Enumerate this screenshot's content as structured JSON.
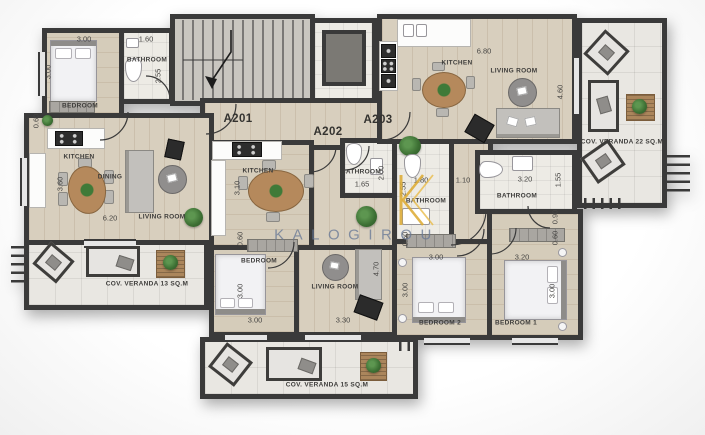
{
  "watermark": {
    "logo_letter": "K",
    "text": "KALOGIROU"
  },
  "colors": {
    "wall": "#3a3a3a",
    "wood_floor": "#d8cfbe",
    "bathroom_floor": "#edebe5",
    "veranda_floor": "#e9e7e2",
    "watermark_blue": "#687896",
    "logo_gold": "#dca92f",
    "plant_green": "#3c6f33",
    "table_wood": "#b5895c"
  },
  "labels": {
    "apartments": [
      {
        "text": "A201",
        "x": 238,
        "y": 119
      },
      {
        "text": "A202",
        "x": 328,
        "y": 132
      },
      {
        "text": "A203",
        "x": 378,
        "y": 120
      }
    ],
    "rooms": [
      {
        "text": "BEDROOM",
        "x": 80,
        "y": 106
      },
      {
        "text": "BATHROOM",
        "x": 147,
        "y": 60
      },
      {
        "text": "KITCHEN",
        "x": 79,
        "y": 157
      },
      {
        "text": "DINING",
        "x": 110,
        "y": 177
      },
      {
        "text": "LIVING ROOM",
        "x": 162,
        "y": 217
      },
      {
        "text": "COV. VERANDA 13 SQ.M",
        "x": 147,
        "y": 284
      },
      {
        "text": "KITCHEN",
        "x": 258,
        "y": 171
      },
      {
        "text": "BATHROOM",
        "x": 361,
        "y": 172
      },
      {
        "text": "BEDROOM",
        "x": 259,
        "y": 261
      },
      {
        "text": "LIVING ROOM",
        "x": 335,
        "y": 287
      },
      {
        "text": "COV. VERANDA 15 SQ.M",
        "x": 327,
        "y": 385
      },
      {
        "text": "KITCHEN",
        "x": 457,
        "y": 63
      },
      {
        "text": "LIVING ROOM",
        "x": 514,
        "y": 71
      },
      {
        "text": "BATHROOM",
        "x": 426,
        "y": 201
      },
      {
        "text": "BATHROOM",
        "x": 517,
        "y": 196
      },
      {
        "text": "BEDROOM 2",
        "x": 440,
        "y": 323
      },
      {
        "text": "BEDROOM 1",
        "x": 516,
        "y": 323
      },
      {
        "text": "COV. VERANDA 22 SQ.M",
        "x": 622,
        "y": 142
      }
    ],
    "dims": [
      {
        "text": "3.00",
        "x": 84,
        "y": 39
      },
      {
        "text": "1.60",
        "x": 146,
        "y": 39
      },
      {
        "text": "3.00",
        "x": 48,
        "y": 72,
        "rot": true
      },
      {
        "text": "2.55",
        "x": 158,
        "y": 76,
        "rot": true
      },
      {
        "text": "0.60",
        "x": 36,
        "y": 121,
        "rot": true
      },
      {
        "text": "3.60",
        "x": 60,
        "y": 184,
        "rot": true
      },
      {
        "text": "6.20",
        "x": 110,
        "y": 218
      },
      {
        "text": "3.10",
        "x": 237,
        "y": 188,
        "rot": true
      },
      {
        "text": "2.00",
        "x": 381,
        "y": 173,
        "rot": true
      },
      {
        "text": "1.65",
        "x": 362,
        "y": 184
      },
      {
        "text": "0.60",
        "x": 240,
        "y": 239,
        "rot": true
      },
      {
        "text": "3.00",
        "x": 240,
        "y": 291,
        "rot": true
      },
      {
        "text": "3.00",
        "x": 255,
        "y": 320
      },
      {
        "text": "3.30",
        "x": 343,
        "y": 320
      },
      {
        "text": "4.70",
        "x": 376,
        "y": 269,
        "rot": true
      },
      {
        "text": "6.80",
        "x": 484,
        "y": 51
      },
      {
        "text": "4.60",
        "x": 560,
        "y": 92,
        "rot": true
      },
      {
        "text": "1.80",
        "x": 421,
        "y": 180
      },
      {
        "text": "2.55",
        "x": 403,
        "y": 189,
        "rot": true
      },
      {
        "text": "1.10",
        "x": 463,
        "y": 180
      },
      {
        "text": "3.20",
        "x": 525,
        "y": 179
      },
      {
        "text": "1.55",
        "x": 558,
        "y": 180,
        "rot": true
      },
      {
        "text": "0.90",
        "x": 555,
        "y": 217,
        "rot": true
      },
      {
        "text": "0.60",
        "x": 555,
        "y": 238,
        "rot": true
      },
      {
        "text": "0.60",
        "x": 405,
        "y": 239,
        "rot": true
      },
      {
        "text": "3.00",
        "x": 436,
        "y": 257
      },
      {
        "text": "3.00",
        "x": 405,
        "y": 290,
        "rot": true
      },
      {
        "text": "3.20",
        "x": 522,
        "y": 257
      },
      {
        "text": "3.00",
        "x": 552,
        "y": 291,
        "rot": true
      }
    ]
  }
}
